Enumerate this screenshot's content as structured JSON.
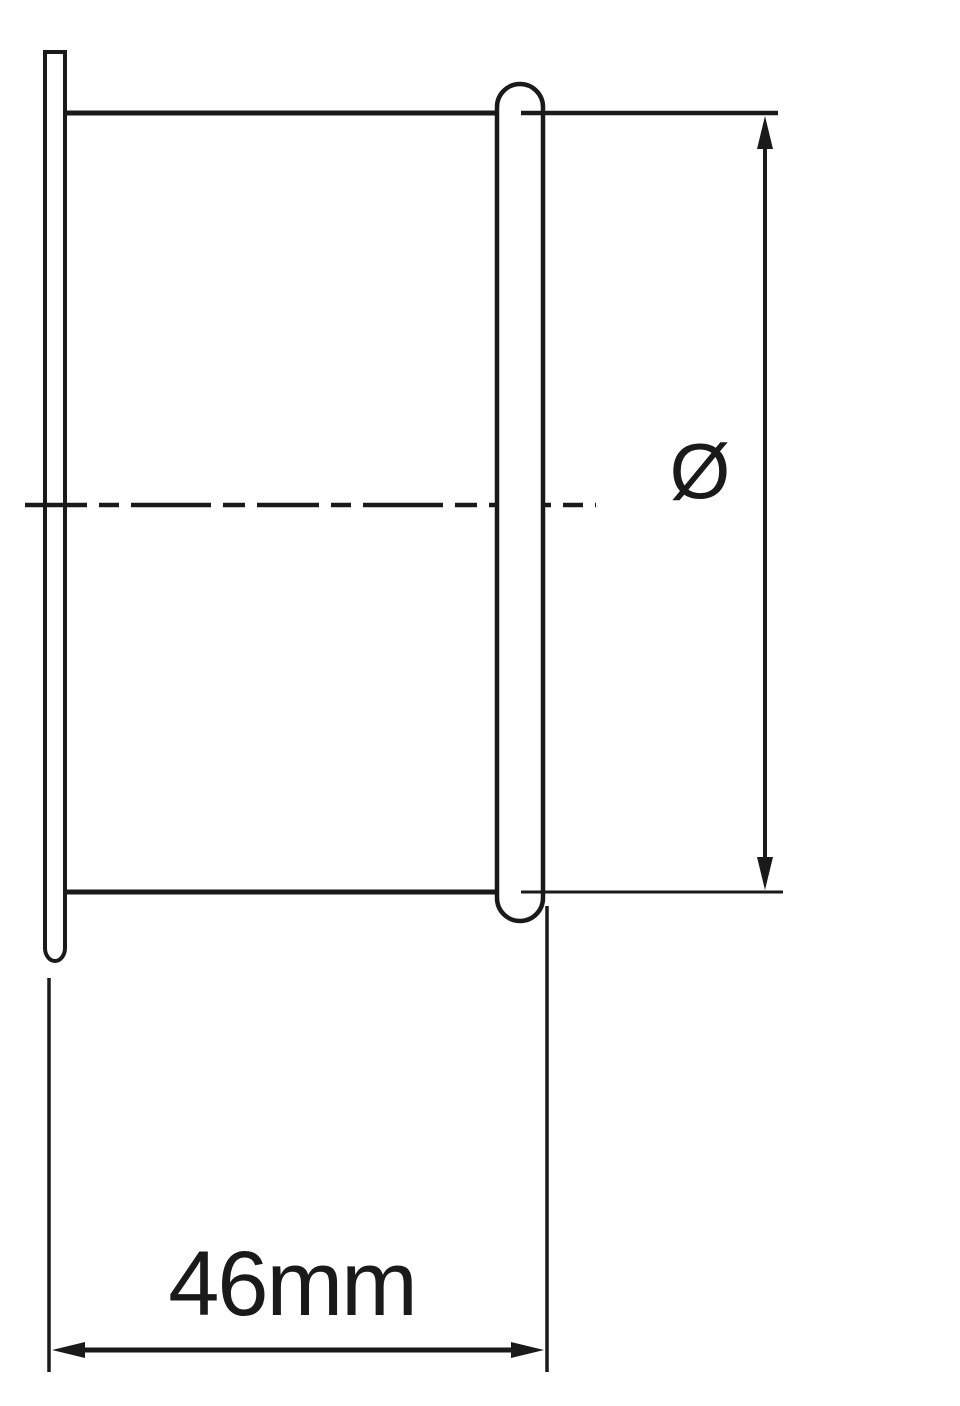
{
  "drawing": {
    "type": "engineering-cross-section",
    "labels": {
      "diameter_symbol": "Ø",
      "length_dimension": "46mm"
    },
    "colors": {
      "line": "#1a1a1a",
      "background": "#ffffff"
    }
  }
}
